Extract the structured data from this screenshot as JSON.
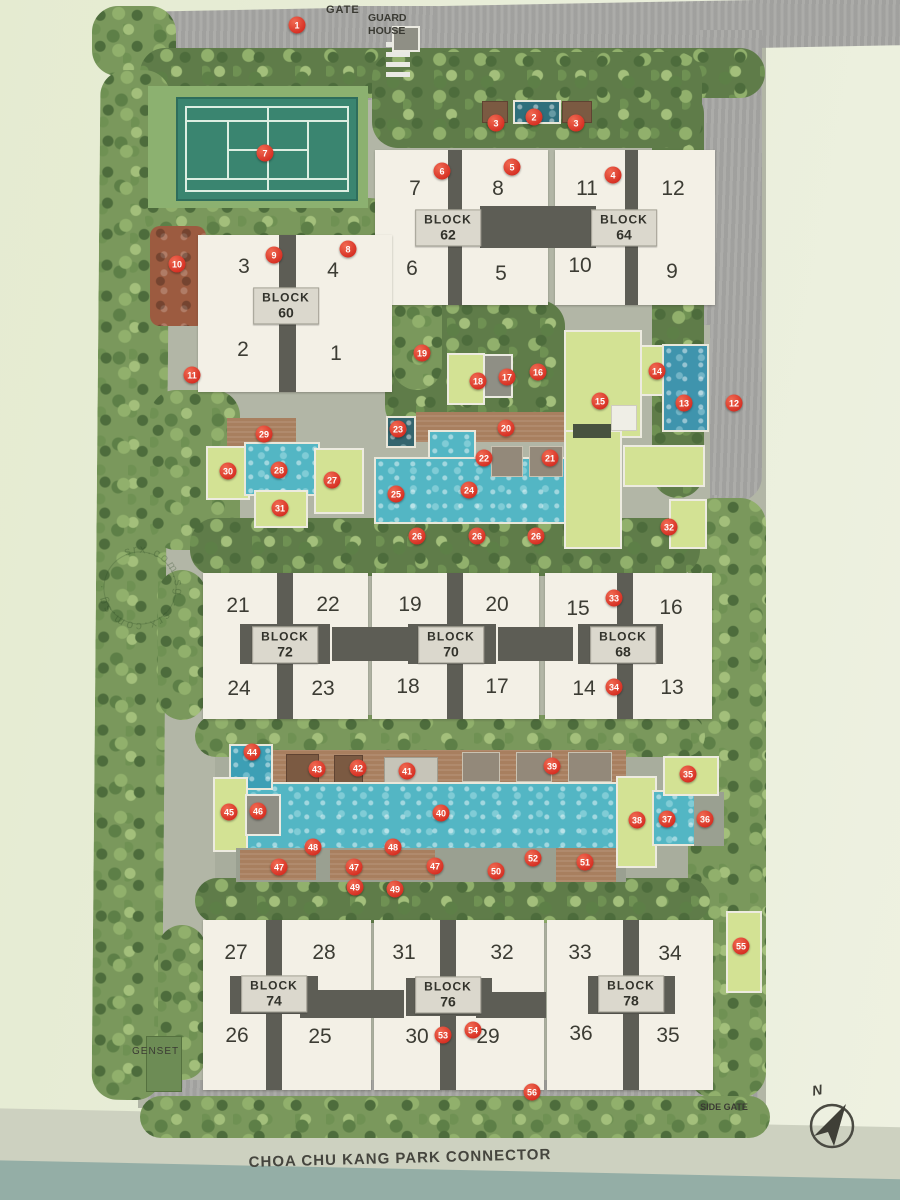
{
  "labels": {
    "gate": "GATE",
    "guard_house": "GUARD HOUSE",
    "side_gate": "SIDE GATE",
    "genset": "GENSET",
    "park_connector": "CHOA CHU KANG PARK CONNECTOR",
    "north": "N",
    "watermark_circle": "srx.com.sg · srx.com.sg ·"
  },
  "colors": {
    "marker_red": "#d62e22",
    "building_cream": "#f3f0e6",
    "block_label_bg": "#dbd8cd",
    "pool_teal": "#53b6c4",
    "lawn_green": "#d3e294",
    "tennis_green": "#3a8570",
    "deck_brown": "#a87f5f",
    "road_grey": "#a6a6a3",
    "canal_water": "#94aea6"
  },
  "blocks": [
    {
      "word": "BLOCK",
      "number": "60",
      "cx": 286,
      "cy": 306,
      "units": [
        {
          "n": "3",
          "x": 244,
          "y": 267
        },
        {
          "n": "4",
          "x": 333,
          "y": 271
        },
        {
          "n": "2",
          "x": 243,
          "y": 350
        },
        {
          "n": "1",
          "x": 336,
          "y": 354
        }
      ]
    },
    {
      "word": "BLOCK",
      "number": "62",
      "cx": 448,
      "cy": 228,
      "units": [
        {
          "n": "7",
          "x": 415,
          "y": 189
        },
        {
          "n": "8",
          "x": 498,
          "y": 189
        },
        {
          "n": "6",
          "x": 412,
          "y": 269
        },
        {
          "n": "5",
          "x": 501,
          "y": 274
        }
      ]
    },
    {
      "word": "BLOCK",
      "number": "64",
      "cx": 624,
      "cy": 228,
      "units": [
        {
          "n": "11",
          "x": 587,
          "y": 189
        },
        {
          "n": "12",
          "x": 673,
          "y": 189
        },
        {
          "n": "10",
          "x": 580,
          "y": 266
        },
        {
          "n": "9",
          "x": 672,
          "y": 272
        }
      ]
    },
    {
      "word": "BLOCK",
      "number": "72",
      "cx": 285,
      "cy": 645,
      "units": [
        {
          "n": "21",
          "x": 238,
          "y": 606
        },
        {
          "n": "22",
          "x": 328,
          "y": 605
        },
        {
          "n": "24",
          "x": 239,
          "y": 689
        },
        {
          "n": "23",
          "x": 323,
          "y": 689
        }
      ]
    },
    {
      "word": "BLOCK",
      "number": "70",
      "cx": 451,
      "cy": 645,
      "units": [
        {
          "n": "19",
          "x": 410,
          "y": 605
        },
        {
          "n": "20",
          "x": 497,
          "y": 605
        },
        {
          "n": "18",
          "x": 408,
          "y": 687
        },
        {
          "n": "17",
          "x": 497,
          "y": 687
        }
      ]
    },
    {
      "word": "BLOCK",
      "number": "68",
      "cx": 623,
      "cy": 645,
      "units": [
        {
          "n": "15",
          "x": 578,
          "y": 609
        },
        {
          "n": "16",
          "x": 671,
          "y": 608
        },
        {
          "n": "14",
          "x": 584,
          "y": 689
        },
        {
          "n": "13",
          "x": 672,
          "y": 688
        }
      ]
    },
    {
      "word": "BLOCK",
      "number": "74",
      "cx": 274,
      "cy": 994,
      "units": [
        {
          "n": "27",
          "x": 236,
          "y": 953
        },
        {
          "n": "28",
          "x": 324,
          "y": 953
        },
        {
          "n": "26",
          "x": 237,
          "y": 1036
        },
        {
          "n": "25",
          "x": 320,
          "y": 1037
        }
      ]
    },
    {
      "word": "BLOCK",
      "number": "76",
      "cx": 448,
      "cy": 995,
      "units": [
        {
          "n": "31",
          "x": 404,
          "y": 953
        },
        {
          "n": "32",
          "x": 502,
          "y": 953
        },
        {
          "n": "30",
          "x": 417,
          "y": 1037
        },
        {
          "n": "29",
          "x": 488,
          "y": 1037
        }
      ]
    },
    {
      "word": "BLOCK",
      "number": "78",
      "cx": 631,
      "cy": 994,
      "units": [
        {
          "n": "33",
          "x": 580,
          "y": 953
        },
        {
          "n": "34",
          "x": 670,
          "y": 954
        },
        {
          "n": "36",
          "x": 581,
          "y": 1034
        },
        {
          "n": "35",
          "x": 668,
          "y": 1036
        }
      ]
    }
  ],
  "markers": [
    {
      "n": "1",
      "x": 297,
      "y": 25
    },
    {
      "n": "2",
      "x": 534,
      "y": 117
    },
    {
      "n": "3",
      "x": 496,
      "y": 123
    },
    {
      "n": "3",
      "x": 576,
      "y": 123
    },
    {
      "n": "4",
      "x": 613,
      "y": 175
    },
    {
      "n": "5",
      "x": 512,
      "y": 167
    },
    {
      "n": "6",
      "x": 442,
      "y": 171
    },
    {
      "n": "7",
      "x": 265,
      "y": 153
    },
    {
      "n": "8",
      "x": 348,
      "y": 249
    },
    {
      "n": "9",
      "x": 274,
      "y": 255
    },
    {
      "n": "10",
      "x": 177,
      "y": 264
    },
    {
      "n": "11",
      "x": 192,
      "y": 375
    },
    {
      "n": "12",
      "x": 734,
      "y": 403
    },
    {
      "n": "13",
      "x": 684,
      "y": 403
    },
    {
      "n": "14",
      "x": 657,
      "y": 371
    },
    {
      "n": "15",
      "x": 600,
      "y": 401
    },
    {
      "n": "16",
      "x": 538,
      "y": 372
    },
    {
      "n": "17",
      "x": 507,
      "y": 377
    },
    {
      "n": "18",
      "x": 478,
      "y": 381
    },
    {
      "n": "19",
      "x": 422,
      "y": 353
    },
    {
      "n": "20",
      "x": 506,
      "y": 428
    },
    {
      "n": "21",
      "x": 550,
      "y": 458
    },
    {
      "n": "22",
      "x": 484,
      "y": 458
    },
    {
      "n": "23",
      "x": 398,
      "y": 429
    },
    {
      "n": "24",
      "x": 469,
      "y": 490
    },
    {
      "n": "25",
      "x": 396,
      "y": 494
    },
    {
      "n": "26",
      "x": 417,
      "y": 536
    },
    {
      "n": "26",
      "x": 477,
      "y": 536
    },
    {
      "n": "26",
      "x": 536,
      "y": 536
    },
    {
      "n": "27",
      "x": 332,
      "y": 480
    },
    {
      "n": "28",
      "x": 279,
      "y": 470
    },
    {
      "n": "29",
      "x": 264,
      "y": 434
    },
    {
      "n": "30",
      "x": 228,
      "y": 471
    },
    {
      "n": "31",
      "x": 280,
      "y": 508
    },
    {
      "n": "32",
      "x": 669,
      "y": 527
    },
    {
      "n": "33",
      "x": 614,
      "y": 598
    },
    {
      "n": "34",
      "x": 614,
      "y": 687
    },
    {
      "n": "35",
      "x": 688,
      "y": 774
    },
    {
      "n": "36",
      "x": 705,
      "y": 819
    },
    {
      "n": "37",
      "x": 667,
      "y": 819
    },
    {
      "n": "38",
      "x": 637,
      "y": 820
    },
    {
      "n": "39",
      "x": 552,
      "y": 766
    },
    {
      "n": "40",
      "x": 441,
      "y": 813
    },
    {
      "n": "41",
      "x": 407,
      "y": 771
    },
    {
      "n": "42",
      "x": 358,
      "y": 768
    },
    {
      "n": "43",
      "x": 317,
      "y": 769
    },
    {
      "n": "44",
      "x": 252,
      "y": 752
    },
    {
      "n": "45",
      "x": 229,
      "y": 812
    },
    {
      "n": "46",
      "x": 258,
      "y": 811
    },
    {
      "n": "47",
      "x": 279,
      "y": 867
    },
    {
      "n": "47",
      "x": 354,
      "y": 867
    },
    {
      "n": "47",
      "x": 435,
      "y": 866
    },
    {
      "n": "48",
      "x": 313,
      "y": 847
    },
    {
      "n": "48",
      "x": 393,
      "y": 847
    },
    {
      "n": "49",
      "x": 355,
      "y": 887
    },
    {
      "n": "49",
      "x": 395,
      "y": 889
    },
    {
      "n": "50",
      "x": 496,
      "y": 871
    },
    {
      "n": "51",
      "x": 585,
      "y": 862
    },
    {
      "n": "52",
      "x": 533,
      "y": 858
    },
    {
      "n": "53",
      "x": 443,
      "y": 1035
    },
    {
      "n": "54",
      "x": 473,
      "y": 1030
    },
    {
      "n": "55",
      "x": 741,
      "y": 946
    },
    {
      "n": "56",
      "x": 532,
      "y": 1092
    }
  ]
}
